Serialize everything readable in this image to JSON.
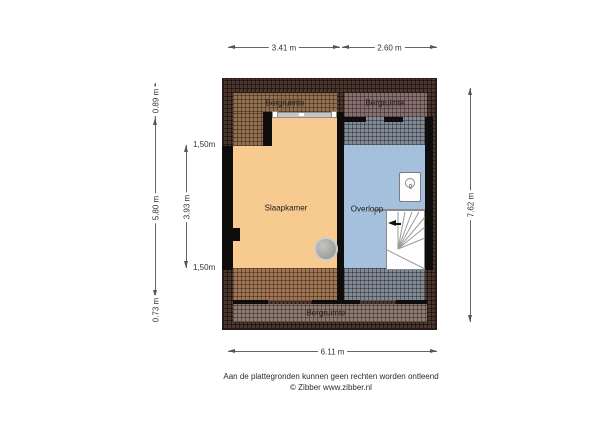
{
  "plan": {
    "title": "attic floor plan",
    "rooms": {
      "bergruimte_top_left": {
        "label": "Bergruimte",
        "color": "#93704f"
      },
      "bergruimte_top_right": {
        "label": "Bergruimte",
        "color": "#867170"
      },
      "slaapkamer": {
        "label": "Slaapkamer",
        "color": "#f7ca90"
      },
      "overloop": {
        "label": "Overloop",
        "color": "#a5c0dc"
      },
      "bergruimte_bottom": {
        "label": "Bergruimte",
        "color": "#8d7a71"
      }
    },
    "zones": {
      "low_headroom_orange": "#a27655",
      "low_headroom_blue": "#7f8b98",
      "roof_edge": "#4b352c",
      "wall": "#0e0d0c"
    },
    "fixtures": {
      "stairs_icon": "winder-staircase",
      "stairs_direction_icon": "arrow-left",
      "boiler_icon": "boiler-unit",
      "flue_icon": "flue-duct-circle"
    },
    "dimensions": {
      "top_left_width": "3.41 m",
      "top_right_width": "2.60 m",
      "left_top": "0.89 m",
      "left_middle": "5.80 m",
      "left_bottom": "0.73 m",
      "inner_top": "1,50m",
      "inner_middle": "3.93 m",
      "inner_bottom": "1,50m",
      "right_height": "7.62 m",
      "bottom_width": "6.11 m"
    }
  },
  "footer": {
    "disclaimer": "Aan de plattegronden kunnen geen rechten worden ontleend",
    "credit": "© Zibber www.zibber.nl"
  }
}
